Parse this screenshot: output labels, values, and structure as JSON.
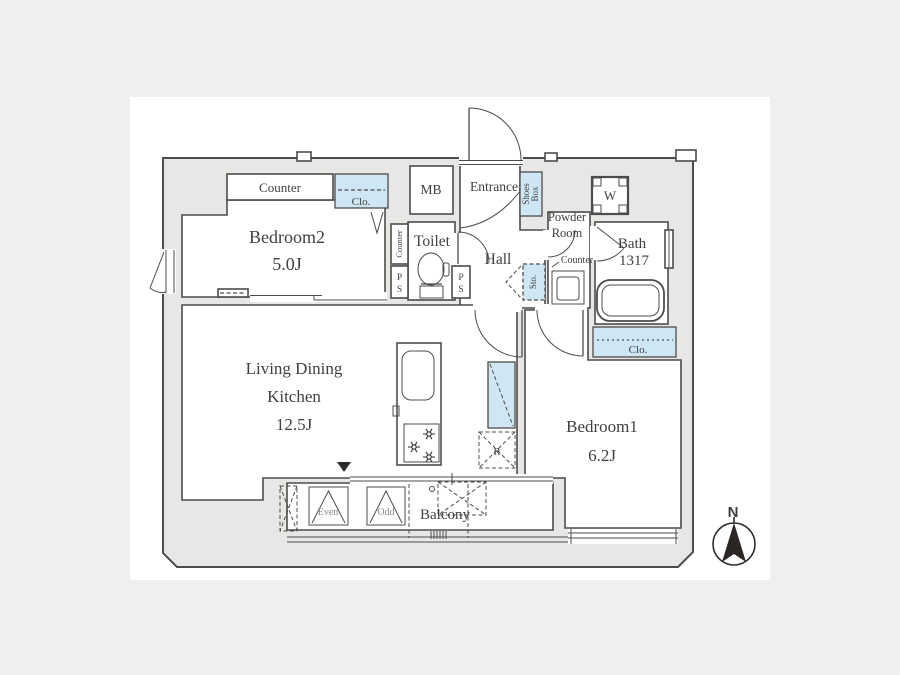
{
  "plan": {
    "rooms": {
      "bedroom2": {
        "name": "Bedroom2",
        "size": "5.0J"
      },
      "bedroom1": {
        "name": "Bedroom1",
        "size": "6.2J"
      },
      "ldk": {
        "name1": "Living Dining",
        "name2": "Kitchen",
        "size": "12.5J"
      },
      "toilet": {
        "name": "Toilet"
      },
      "hall": {
        "name": "Hall"
      },
      "entrance": {
        "name": "Entrance"
      },
      "powder_room": {
        "name1": "Powder",
        "name2": "Room"
      },
      "bath": {
        "name": "Bath",
        "size": "1317"
      },
      "balcony": {
        "name": "Balcony"
      },
      "meter_box": {
        "name": "MB"
      }
    },
    "fixtures": {
      "counter_bedroom2": "Counter",
      "counter_toilet": "Counter",
      "counter_powder": "Counter",
      "closet_bedroom2": "Clo.",
      "closet_bedroom1": "Clo.",
      "shoes_box1": "Shoes",
      "shoes_box2": "Box",
      "storage": "Sto.",
      "ps_p": "P",
      "ps_s": "S",
      "washer": "W",
      "refrigerator": "R",
      "ac_even": "Even",
      "ac_odd": "Odd"
    },
    "compass_north": "N",
    "colors": {
      "wall_fill": "#e9e7e5",
      "outline": "#4e4c4a",
      "closet_blue": "#cfe7f5",
      "sheet": "#ffffff",
      "background": "#f0efee"
    }
  }
}
